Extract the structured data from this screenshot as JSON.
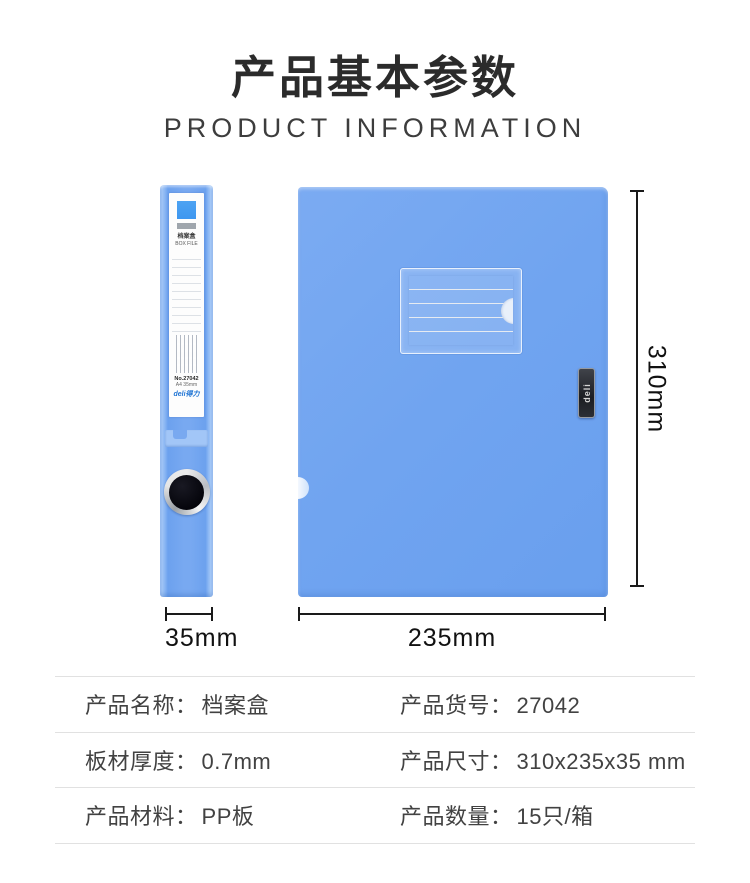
{
  "header": {
    "title": "产品基本参数",
    "subtitle": "PRODUCT INFORMATION"
  },
  "product_views": {
    "spine_label": {
      "title_cn": "档案盒",
      "title_en": "BOX FILE",
      "model": "No.27042",
      "spec": "A4 35mm",
      "brand": "deli得力"
    },
    "front_badge": "deli",
    "dimensions": {
      "spine_width": "35mm",
      "front_width": "235mm",
      "front_height": "310mm"
    }
  },
  "specs_table": {
    "rows": [
      {
        "cells": [
          {
            "label": "产品名称：",
            "value": "档案盒"
          },
          {
            "label": "产品货号：",
            "value": "27042"
          }
        ]
      },
      {
        "cells": [
          {
            "label": "板材厚度：",
            "value": "0.7mm"
          },
          {
            "label": "产品尺寸：",
            "value": "310x235x35 mm"
          }
        ]
      },
      {
        "cells": [
          {
            "label": "产品材料：",
            "value": "PP板"
          },
          {
            "label": "产品数量：",
            "value": "15只/箱"
          }
        ]
      }
    ]
  },
  "colors": {
    "title-text": "#2b2b2b",
    "body-text": "#424242",
    "divider": "#e1e1e1",
    "dim-line": "#1a1a1a",
    "box-blue": "#70a4f0",
    "box-blue-light": "#a9ccf8",
    "label-square-blue": "#3e97f0",
    "brand-blue": "#1f74d4",
    "badge-dark": "#26282c"
  }
}
